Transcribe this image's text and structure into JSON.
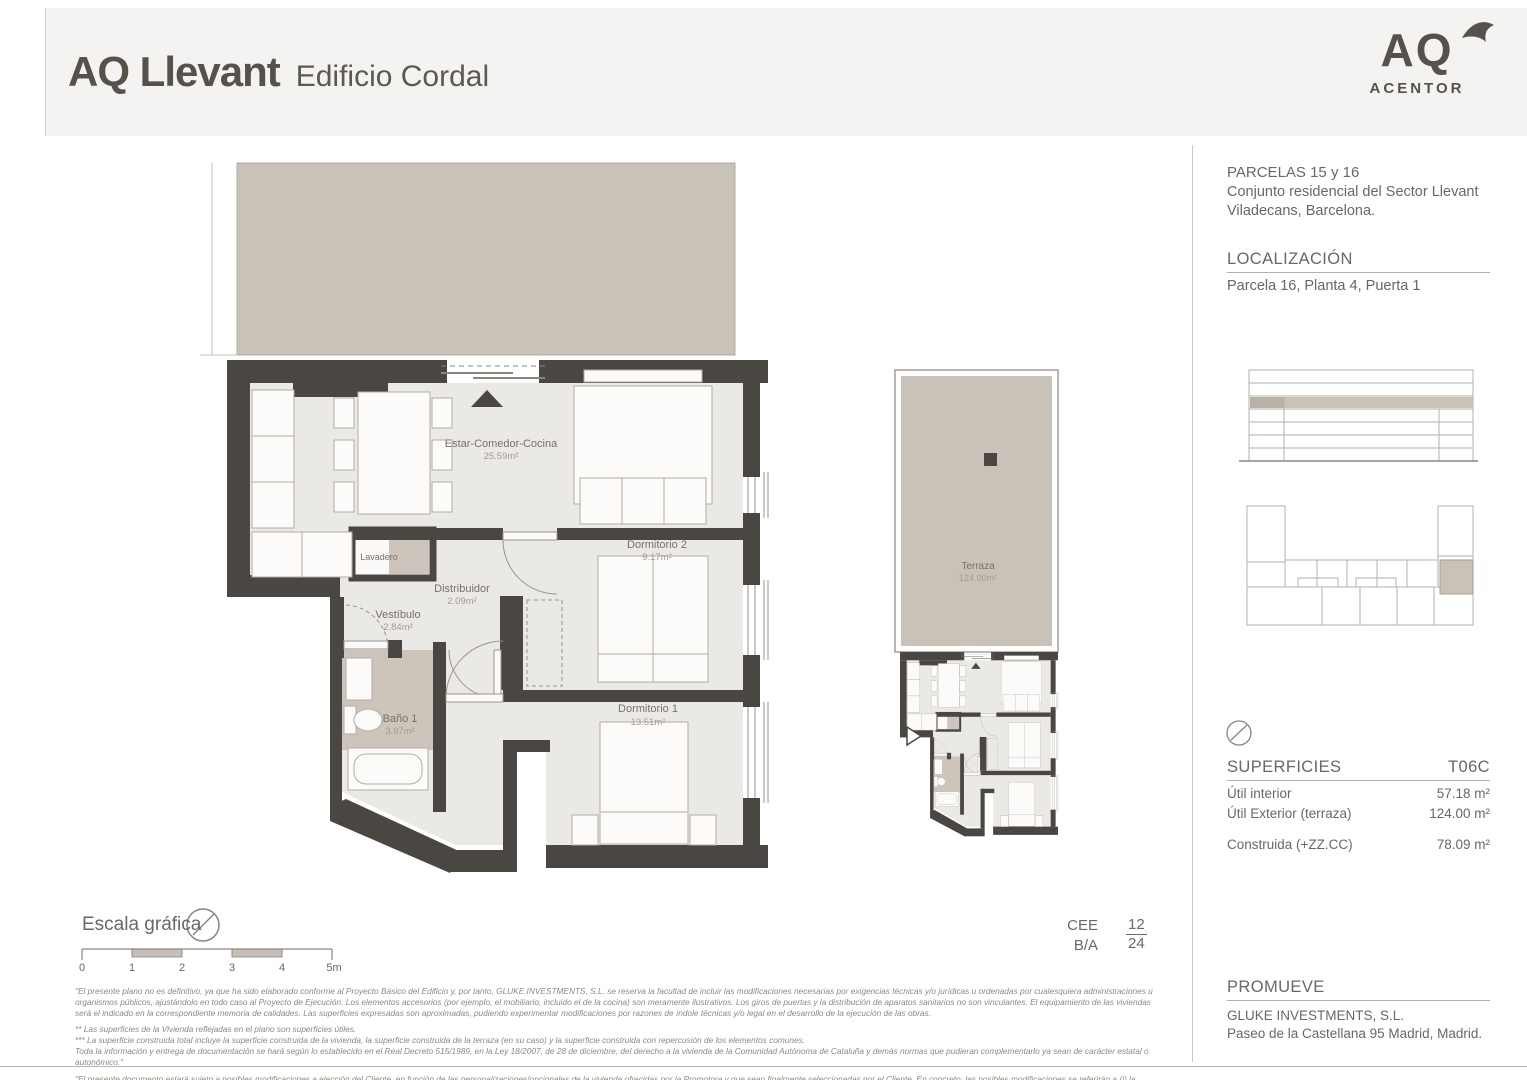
{
  "header": {
    "title": "AQ Llevant",
    "subtitle": "Edificio Cordal"
  },
  "logo": {
    "monogram": "AQ",
    "brand": "ACENTOR"
  },
  "project": {
    "parcels": "PARCELAS 15 y 16",
    "line1": "Conjunto residencial del Sector Llevant",
    "line2": "Viladecans, Barcelona."
  },
  "location": {
    "heading": "LOCALIZACIÓN",
    "value": "Parcela 16, Planta 4, Puerta 1"
  },
  "rooms": {
    "estar": {
      "name": "Estar-Comedor-Cocina",
      "area": "25.59m²"
    },
    "dorm2": {
      "name": "Dormitorio 2",
      "area": "9.17m²"
    },
    "distribuidor": {
      "name": "Distribuidor",
      "area": "2.09m²"
    },
    "vestibulo": {
      "name": "Vestíbulo",
      "area": "2.84m²"
    },
    "lavadero": {
      "name": "Lavadero"
    },
    "bano1": {
      "name": "Baño 1",
      "area": "3.97m²"
    },
    "dorm1": {
      "name": "Dormitorio 1",
      "area": "13.51m²"
    },
    "terraza": {
      "name": "Terraza",
      "area": "124.00m²"
    }
  },
  "surfaces": {
    "heading": "SUPERFICIES",
    "type_code": "T06C",
    "rows": [
      {
        "label": "Útil interior",
        "value": "57.18 m²"
      },
      {
        "label": "Útil Exterior (terraza)",
        "value": "124.00 m²"
      },
      {
        "label": "Construida (+ZZ.CC)",
        "value": "78.09 m²"
      }
    ]
  },
  "promoter": {
    "heading": "PROMUEVE",
    "name": "GLUKE INVESTMENTS, S.L.",
    "address": "Paseo de la Castellana 95 Madrid, Madrid."
  },
  "scalebar": {
    "label": "Escala gráfica",
    "ticks": [
      "0",
      "1",
      "2",
      "3",
      "4",
      "5m"
    ]
  },
  "energy": {
    "cert": "CEE",
    "rating": "B/A",
    "numerator": "12",
    "denominator": "24"
  },
  "disclaimer": {
    "p1": "\"El presente plano no es definitivo, ya que ha sido elaborado conforme al Proyecto Básico del Edificio y, por tanto, GLUKE INVESTMENTS, S.L. se reserva la facultad de incluir las modificaciones necesarias por exigencias técnicas y/o jurídicas u ordenadas por cualesquiera administraciones u organismos públicos, ajustándolo en todo caso al Proyecto de Ejecución. Los elementos accesorios (por ejemplo, el mobiliario, incluido el de la cocina) son meramente ilustrativos. Los giros de puertas y la distribución de aparatos sanitarios no son vinculantes. El equipamiento de las viviendas será el indicado en la correspondiente memoria de calidades. Las superficies expresadas son aproximadas, pudiendo experimentar modificaciones por razones de índole técnicas y/o legal en el desarrollo de la ejecución de las obras.",
    "p2a": "** Las superficies de la Vivienda reflejadas en el plano son superficies útiles.",
    "p2b": "*** La superficie construida total incluye la superficie construida de la vivienda, la superficie construida de la terraza (en su caso) y la superficie construida con repercusión de los elementos comunes.",
    "p2c": "Toda la información y entrega de documentación se hará según lo establecido en el Real Decreto 515/1989, en la Ley 18/2007, de 28 de diciembre, del derecho a la vivienda de la Comunidad Autónoma de Cataluña y demás normas que pudieran complementarlo ya sean de carácter estatal o autonómico.\"",
    "p3": "\"El presente documento estará sujeto a posibles modificaciones a elección del Cliente, en función de las personalizaciones/opcionales de la vivienda ofrecidas por la Promotora y que sean finalmente seleccionadas por el Cliente. En concreto, las posibles modificaciones se referirán a (i) la instalación de armarios en dormitorios en las zonas representadas gráficamente con línea discontinua en el plano; y, (ii) la sustitución de bañera por plato de ducha en el Baño 2. Una vez seleccionada por parte del Cliente, las Partes firmarán una adenda recogiendo estas modificaciones, y, en todo caso, en el momento de la formalización de la escritura pública de compraventa se incorporará el plano definitivo de la Vivienda\""
  },
  "colors": {
    "beige": "#c9c2b8",
    "wall": "#4a4743",
    "floor": "#ebe9e6",
    "text_dark": "#55524c",
    "text_mid": "#6b6762",
    "text_light": "#8a867f"
  }
}
